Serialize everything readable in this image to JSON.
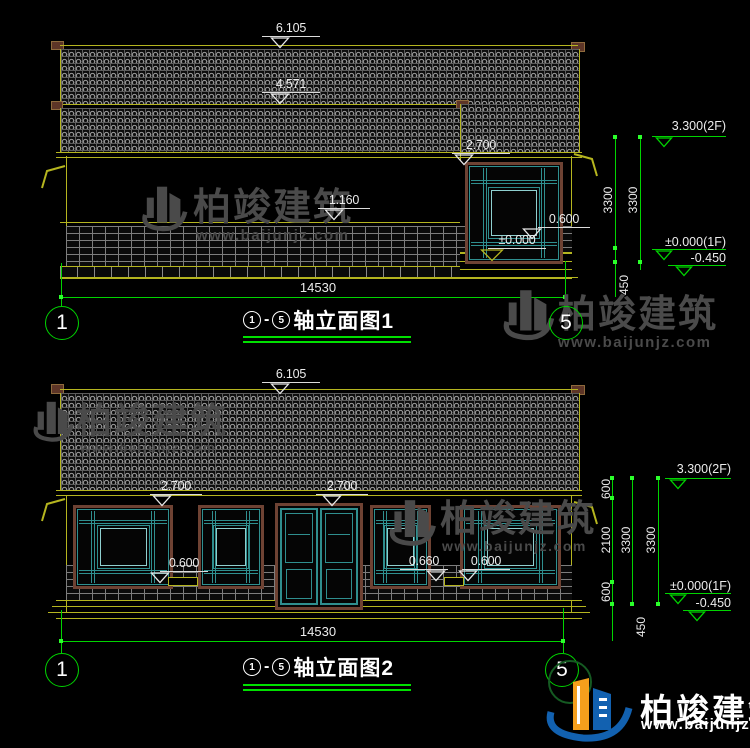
{
  "watermark": {
    "brand": "柏竣建筑",
    "url": "www.baijunjz.com"
  },
  "footer": {
    "brand": "柏竣建筑",
    "url": "www.baijunjz.com"
  },
  "drawing1": {
    "levels": {
      "ridge": "6.105",
      "upper_eave": "4.571",
      "eave": "2.700",
      "window_head": "1.160",
      "sill": "0.600",
      "zero": "±0.000"
    },
    "width_dim": "14530",
    "right": {
      "level_2f": "3.300(2F)",
      "h1": "3300",
      "h2": "3300",
      "level_1f": "±0.000(1F)",
      "level_base": "-0.450",
      "base_h": "450"
    },
    "axis": {
      "left": "1",
      "right": "5"
    },
    "title": {
      "n1": "1",
      "dash": "-",
      "n2": "5",
      "text": "轴立面图1"
    }
  },
  "drawing2": {
    "levels": {
      "ridge": "6.105",
      "eave_left": "2.700",
      "eave_right": "2.700",
      "sill_left": "0.600",
      "sill_mid": "0.660",
      "sill_right": "0.600"
    },
    "width_dim": "14530",
    "right": {
      "level_2f": "3.300(2F)",
      "s1": "600",
      "s2": "2100",
      "s3": "600",
      "h1": "3300",
      "h2": "3300",
      "level_1f": "±0.000(1F)",
      "level_base": "-0.450",
      "base_h": "450"
    },
    "axis": {
      "left": "1",
      "right": "5"
    },
    "title": {
      "n1": "1",
      "dash": "-",
      "n2": "5",
      "text": "轴立面图2"
    }
  }
}
